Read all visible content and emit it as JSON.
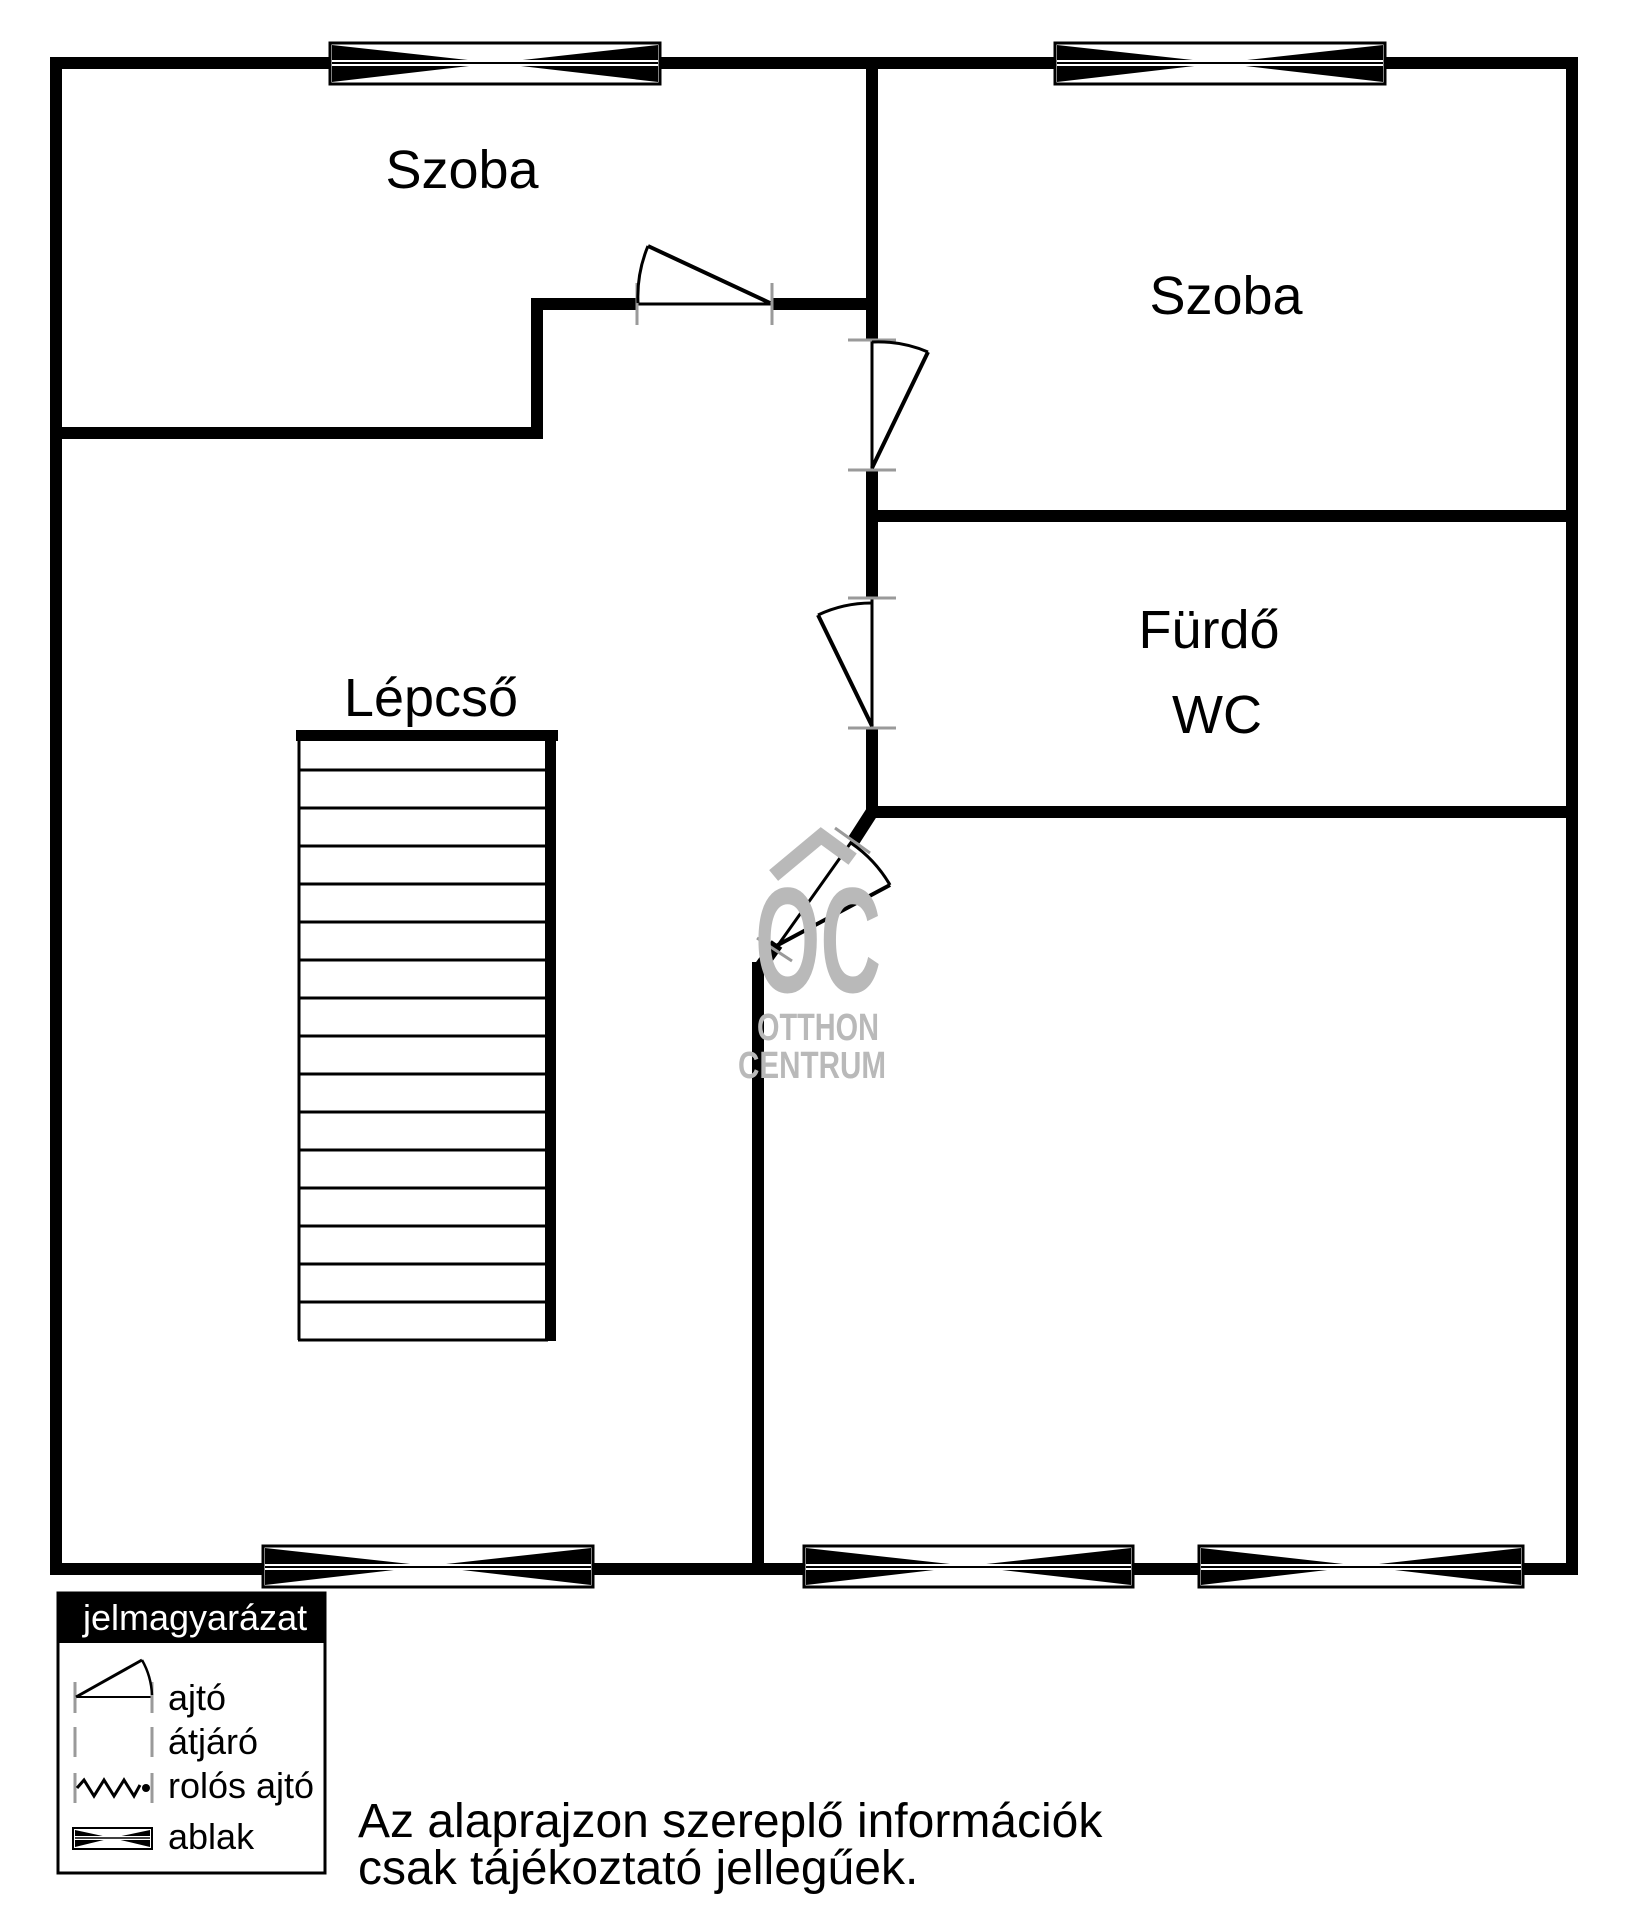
{
  "plan": {
    "rooms": {
      "szoba_left": "Szoba",
      "szoba_right": "Szoba",
      "furdo": "Fürdő",
      "wc": "WC",
      "lepcso": "Lépcső"
    }
  },
  "watermark": {
    "logo": "OC",
    "line1": "OTTHON",
    "line2": "CENTRUM",
    "color": "#b9b9b9"
  },
  "legend": {
    "title": "jelmagyarázat",
    "items": [
      {
        "symbol": "door-arc",
        "label": "ajtó"
      },
      {
        "symbol": "passage",
        "label": "átjáró"
      },
      {
        "symbol": "roller-door",
        "label": "rolós ajtó"
      },
      {
        "symbol": "window",
        "label": "ablak"
      }
    ]
  },
  "disclaimer": {
    "line1": "Az alaprajzon szereplő információk",
    "line2": "csak tájékoztató jellegűek."
  },
  "colors": {
    "wall": "#000000",
    "watermark": "#b9b9b9",
    "tick": "#9a9a9a"
  }
}
